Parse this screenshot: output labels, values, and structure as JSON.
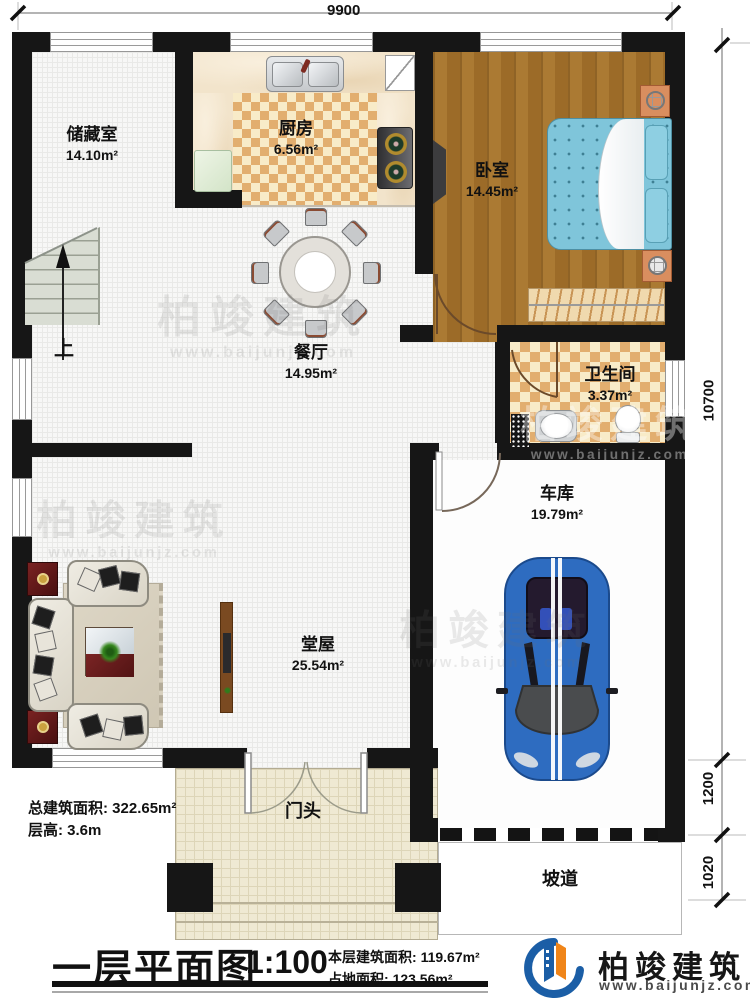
{
  "title": {
    "name": "一层平面图",
    "scale": "1:100"
  },
  "dimensions": {
    "top": "9900",
    "right_total": "10700",
    "right_mid": "1200",
    "right_bottom": "1020"
  },
  "rooms": {
    "storage": {
      "name": "储藏室",
      "area": "14.10m²"
    },
    "kitchen": {
      "name": "厨房",
      "area": "6.56m²"
    },
    "bedroom": {
      "name": "卧室",
      "area": "14.45m²"
    },
    "dining": {
      "name": "餐厅",
      "area": "14.95m²"
    },
    "bathroom": {
      "name": "卫生间",
      "area": "3.37m²"
    },
    "garage": {
      "name": "车库",
      "area": "19.79m²"
    },
    "hall": {
      "name": "堂屋",
      "area": "25.54m²"
    },
    "porch": {
      "name": "门头"
    },
    "ramp": {
      "name": "坡道"
    }
  },
  "stairs": {
    "up_label": "上"
  },
  "stats": {
    "total_area_label": "总建筑面积:",
    "total_area_value": "322.65m²",
    "floor_height_label": "层高:",
    "floor_height_value": "3.6m",
    "this_floor_label": "本层建筑面积:",
    "this_floor_value": "119.67m²",
    "footprint_label": "占地面积:",
    "footprint_value": "123.56m²"
  },
  "brand": {
    "name": "柏竣建筑",
    "url": "www.baijunjz.com"
  },
  "colors": {
    "wall": "#161616",
    "brand_blue": "#1b5ea6",
    "brand_orange": "#f08519"
  }
}
